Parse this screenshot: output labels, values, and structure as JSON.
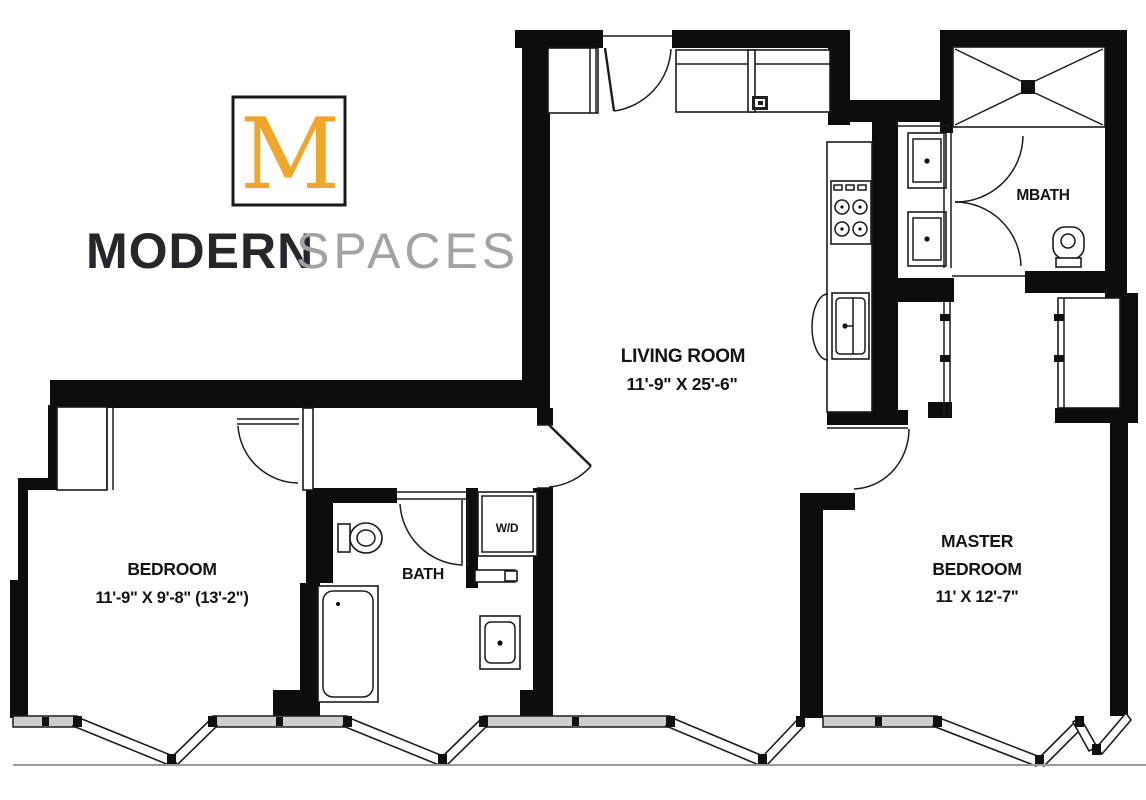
{
  "logo": {
    "monogram": "M",
    "brand_bold": "MODERN",
    "brand_light": "SPACES"
  },
  "colors": {
    "gold": "#EFA62B",
    "dark": "#26272B",
    "gray": "#A0A2A6",
    "wall": "#0D0D0D"
  },
  "rooms": {
    "living_room": {
      "name": "LIVING ROOM",
      "dims": "11'-9\" X 25'-6\""
    },
    "bedroom": {
      "name": "BEDROOM",
      "dims": "11'-9\" X 9'-8\" (13'-2\")"
    },
    "master_bedroom": {
      "name_line1": "MASTER",
      "name_line2": "BEDROOM",
      "dims": "11' X 12'-7\""
    },
    "bath": {
      "name": "BATH"
    },
    "master_bath": {
      "name": "MBATH"
    },
    "laundry": {
      "name": "W/D"
    }
  }
}
